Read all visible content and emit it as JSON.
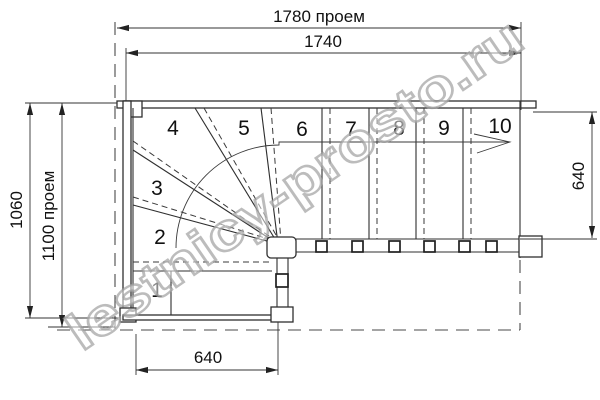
{
  "watermark": "lestnicy-prosto.ru",
  "dimensions": {
    "top_opening": "1780 проем",
    "top_stair": "1740",
    "left_height": "1060",
    "left_opening": "1100 проем",
    "right_width": "640",
    "bottom_width": "640"
  },
  "step_labels": [
    "1",
    "2",
    "3",
    "4",
    "5",
    "6",
    "7",
    "8",
    "9",
    "10"
  ],
  "colors": {
    "line": "#2f2f2f",
    "dimension": "#333333",
    "watermark_outline": "#9f9f9f",
    "background": "#ffffff"
  }
}
